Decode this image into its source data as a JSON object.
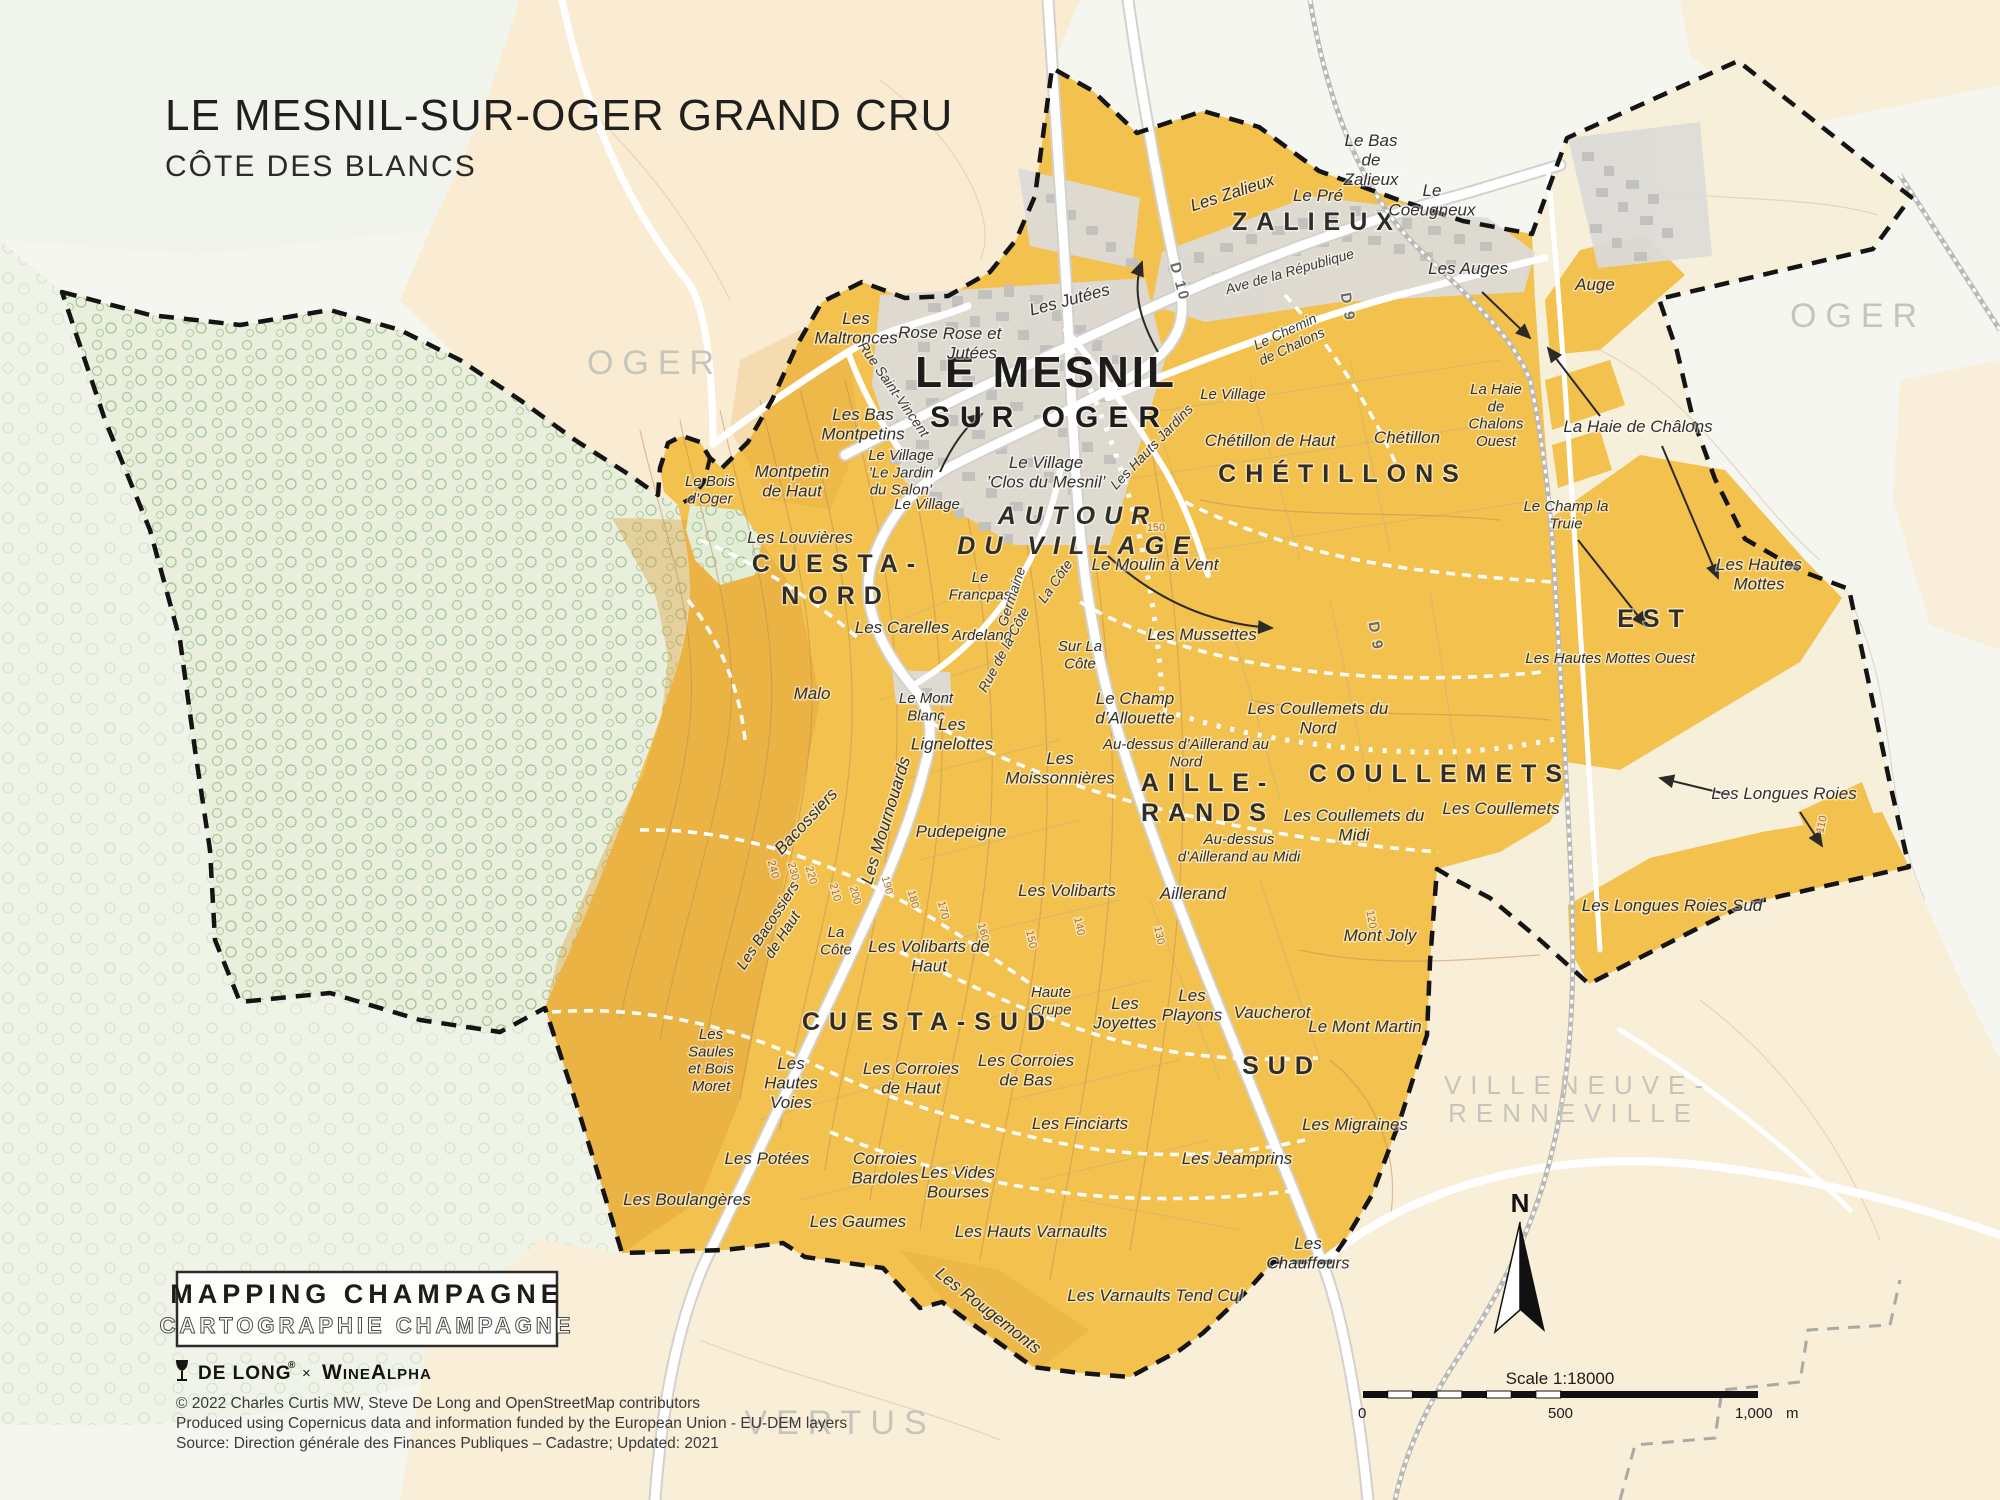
{
  "title": {
    "main": "LE MESNIL-SUR-OGER GRAND CRU",
    "subtitle": "CÔTE DES BLANCS"
  },
  "north": {
    "label": "N"
  },
  "scale_bar": {
    "title": "Scale 1:18000",
    "ticks": [
      "0",
      "500",
      "1,000"
    ],
    "unit": "m"
  },
  "footer": {
    "brand_primary": "MAPPING CHAMPAGNE",
    "brand_secondary": "CARTOGRAPHIE CHAMPAGNE",
    "logo_text": "DE LONG",
    "logo_reg": "®",
    "logo_sep": "×",
    "logo_partner": "WineAlpha",
    "credits": [
      "© 2022 Charles Curtis MW, Steve De Long and OpenStreetMap contributors",
      "Produced using Copernicus data and information funded by the European Union - EU-DEM layers",
      "Source: Direction générale des Finances Publiques – Cadastre; Updated: 2021"
    ]
  },
  "colors": {
    "vineyard": "#F2C14E",
    "vineyard_shade": "#DD9E35",
    "forest": "#E9EFDC",
    "forest_tree": "#A9C79B",
    "peach": "#FAECD2",
    "cream": "#F6EFDA",
    "town_block": "#DCDBD7",
    "building": "#C2C1BD",
    "boundary": "#141414",
    "contour": "#BF8A55",
    "neighbor_gray": "#C7C4BC"
  },
  "labels": [
    {
      "t": "CUESTA-",
      "x": 838,
      "y": 572,
      "c": "region"
    },
    {
      "t": "NORD",
      "x": 836,
      "y": 604,
      "c": "region"
    },
    {
      "t": "CUESTA-SUD",
      "x": 928,
      "y": 1030,
      "c": "region"
    },
    {
      "t": "AUTOUR",
      "x": 1078,
      "y": 524,
      "c": "regionI"
    },
    {
      "t": "DU VILLAGE",
      "x": 1078,
      "y": 554,
      "c": "regionI"
    },
    {
      "t": "ZALIEUX",
      "x": 1317,
      "y": 230,
      "c": "region"
    },
    {
      "t": "CHÉTILLONS",
      "x": 1343,
      "y": 482,
      "c": "region"
    },
    {
      "t": "COULLEMETS",
      "x": 1440,
      "y": 782,
      "c": "region"
    },
    {
      "t": "AILLE-",
      "x": 1208,
      "y": 791,
      "c": "region"
    },
    {
      "t": "RANDS",
      "x": 1208,
      "y": 821,
      "c": "region"
    },
    {
      "t": "SUD",
      "x": 1282,
      "y": 1074,
      "c": "region"
    },
    {
      "t": "EST",
      "x": 1655,
      "y": 627,
      "c": "region"
    },
    {
      "t": "LE MESNIL",
      "x": 1046,
      "y": 387,
      "c": "town1"
    },
    {
      "t": "SUR OGER",
      "x": 1050,
      "y": 427,
      "c": "town2"
    },
    {
      "t": "OGER",
      "x": 655,
      "y": 374,
      "c": "neighbor"
    },
    {
      "t": "OGER",
      "x": 1858,
      "y": 327,
      "c": "neighbor"
    },
    {
      "t": "VERTUS",
      "x": 840,
      "y": 1434,
      "c": "neighbor"
    },
    {
      "t": "VILLENEUVE-",
      "x": 1578,
      "y": 1094,
      "c": "neighbor",
      "s": 26
    },
    {
      "t": "RENNEVILLE",
      "x": 1574,
      "y": 1122,
      "c": "neighbor",
      "s": 26
    },
    {
      "lines": [
        "Les",
        "Maltronces"
      ],
      "x": 856,
      "y": 324,
      "c": "lieu"
    },
    {
      "t": "Rose",
      "x": 918,
      "y": 338,
      "c": "lieu"
    },
    {
      "lines": [
        "Rose et",
        "Jutées"
      ],
      "x": 972,
      "y": 339,
      "c": "lieu"
    },
    {
      "t": "Les Jutées",
      "x": 1071,
      "y": 305,
      "c": "lieu",
      "r": -15
    },
    {
      "t": "Le Pré",
      "x": 1318,
      "y": 201,
      "c": "lieu"
    },
    {
      "lines": [
        "Le Bas",
        "de",
        "Zalieux"
      ],
      "x": 1371,
      "y": 146,
      "c": "lieu"
    },
    {
      "lines": [
        "Le",
        "Coeugneux"
      ],
      "x": 1432,
      "y": 196,
      "c": "lieu"
    },
    {
      "t": "Les Zalieux",
      "x": 1234,
      "y": 198,
      "c": "lieu",
      "r": -18
    },
    {
      "t": "Les Auges",
      "x": 1468,
      "y": 274,
      "c": "lieu"
    },
    {
      "t": "Auge",
      "x": 1595,
      "y": 290,
      "c": "lieu"
    },
    {
      "lines": [
        "La Haie",
        "de",
        "Chalons",
        "Ouest"
      ],
      "x": 1496,
      "y": 394,
      "c": "lieu",
      "s": 15
    },
    {
      "t": "La Haie de Châlons",
      "x": 1638,
      "y": 432,
      "c": "lieu"
    },
    {
      "lines": [
        "Le Champ la",
        "Truie"
      ],
      "x": 1566,
      "y": 511,
      "c": "lieu",
      "s": 15
    },
    {
      "lines": [
        "Les Hautes",
        "Mottes"
      ],
      "x": 1759,
      "y": 570,
      "c": "lieu"
    },
    {
      "t": "Les Hautes Mottes Ouest",
      "x": 1610,
      "y": 663,
      "c": "lieu",
      "s": 15
    },
    {
      "t": "Les Longues Roies",
      "x": 1784,
      "y": 799,
      "c": "lieu"
    },
    {
      "t": "Les Longues Roies Sud",
      "x": 1672,
      "y": 911,
      "c": "lieu"
    },
    {
      "lines": [
        "Les Bas",
        "Montpetins"
      ],
      "x": 863,
      "y": 420,
      "c": "lieu"
    },
    {
      "lines": [
        "Le Village",
        "’Le Jardin",
        "du Salon’"
      ],
      "x": 901,
      "y": 460,
      "c": "lieu",
      "s": 15
    },
    {
      "lines": [
        "Le Village",
        "’Clos du Mesnil’"
      ],
      "x": 1046,
      "y": 468,
      "c": "lieu"
    },
    {
      "t": "Le Village",
      "x": 927,
      "y": 509,
      "c": "lieu",
      "s": 15
    },
    {
      "t": "Le Village",
      "x": 1233,
      "y": 399,
      "c": "lieu",
      "s": 15
    },
    {
      "lines": [
        "Montpetin",
        "de Haut"
      ],
      "x": 792,
      "y": 477,
      "c": "lieu"
    },
    {
      "lines": [
        "Le Bois",
        "d’Oger"
      ],
      "x": 710,
      "y": 486,
      "c": "lieu",
      "s": 15
    },
    {
      "t": "Les Louvières",
      "x": 800,
      "y": 543,
      "c": "lieu"
    },
    {
      "t": "Les Carelles",
      "x": 902,
      "y": 633,
      "c": "lieu"
    },
    {
      "t": "Malo",
      "x": 812,
      "y": 699,
      "c": "lieu"
    },
    {
      "lines": [
        "Le",
        "Francpas"
      ],
      "x": 980,
      "y": 582,
      "c": "lieu",
      "s": 15
    },
    {
      "t": "Ardeland",
      "x": 982,
      "y": 640,
      "c": "lieu",
      "s": 15
    },
    {
      "lines": [
        "Sur La",
        "Côte"
      ],
      "x": 1080,
      "y": 651,
      "c": "lieu",
      "s": 15
    },
    {
      "lines": [
        "Le Mont",
        "Blanc"
      ],
      "x": 926,
      "y": 703,
      "c": "lieu",
      "s": 15
    },
    {
      "lines": [
        "Les",
        "Lignelottes"
      ],
      "x": 952,
      "y": 730,
      "c": "lieu"
    },
    {
      "lines": [
        "Les",
        "Moissonnières"
      ],
      "x": 1060,
      "y": 764,
      "c": "lieu"
    },
    {
      "t": "Chétillon de Haut",
      "x": 1270,
      "y": 446,
      "c": "lieu"
    },
    {
      "t": "Chétillon",
      "x": 1407,
      "y": 443,
      "c": "lieu"
    },
    {
      "t": "Le Moulin à Vent",
      "x": 1155,
      "y": 570,
      "c": "lieu"
    },
    {
      "t": "Les Mussettes",
      "x": 1202,
      "y": 640,
      "c": "lieu"
    },
    {
      "lines": [
        "Le Champ",
        "d’Allouette"
      ],
      "x": 1135,
      "y": 704,
      "c": "lieu"
    },
    {
      "lines": [
        "Les Coullemets du",
        "Nord"
      ],
      "x": 1318,
      "y": 714,
      "c": "lieu"
    },
    {
      "lines": [
        "Au-dessus d’Aillerand au",
        "Nord"
      ],
      "x": 1186,
      "y": 749,
      "c": "lieu",
      "s": 15
    },
    {
      "lines": [
        "Les Coullemets du",
        "Midi"
      ],
      "x": 1354,
      "y": 821,
      "c": "lieu"
    },
    {
      "t": "Les Coullemets",
      "x": 1501,
      "y": 814,
      "c": "lieu"
    },
    {
      "lines": [
        "Au-dessus",
        "d’Aillerand au Midi"
      ],
      "x": 1239,
      "y": 844,
      "c": "lieu",
      "s": 15
    },
    {
      "t": "Aillerand",
      "x": 1193,
      "y": 899,
      "c": "lieu"
    },
    {
      "t": "Les Volibarts",
      "x": 1067,
      "y": 896,
      "c": "lieu"
    },
    {
      "t": "Mont Joly",
      "x": 1380,
      "y": 941,
      "c": "lieu"
    },
    {
      "t": "Bacossiers",
      "x": 810,
      "y": 825,
      "c": "lieu",
      "r": -47
    },
    {
      "t": "Les Mournouards",
      "x": 891,
      "y": 822,
      "c": "lieu",
      "r": -73
    },
    {
      "t": "Pudepeigne",
      "x": 961,
      "y": 837,
      "c": "lieu"
    },
    {
      "lines": [
        "Les Bacossiers",
        "de Haut"
      ],
      "x": 772,
      "y": 928,
      "c": "lieu",
      "r": -57,
      "s": 15
    },
    {
      "lines": [
        "La",
        "Côte"
      ],
      "x": 836,
      "y": 937,
      "c": "lieu",
      "s": 15
    },
    {
      "lines": [
        "Les Volibarts de",
        "Haut"
      ],
      "x": 929,
      "y": 952,
      "c": "lieu"
    },
    {
      "lines": [
        "Haute",
        "Crupe"
      ],
      "x": 1051,
      "y": 997,
      "c": "lieu",
      "s": 15
    },
    {
      "lines": [
        "Les",
        "Joyettes"
      ],
      "x": 1125,
      "y": 1009,
      "c": "lieu"
    },
    {
      "lines": [
        "Les",
        "Playons"
      ],
      "x": 1192,
      "y": 1001,
      "c": "lieu"
    },
    {
      "t": "Vaucherot",
      "x": 1272,
      "y": 1018,
      "c": "lieu"
    },
    {
      "t": "Le Mont Martin",
      "x": 1365,
      "y": 1032,
      "c": "lieu"
    },
    {
      "lines": [
        "Les",
        "Saules",
        "et Bois",
        "Moret"
      ],
      "x": 711,
      "y": 1039,
      "c": "lieu",
      "s": 15
    },
    {
      "lines": [
        "Les",
        "Hautes",
        "Voies"
      ],
      "x": 791,
      "y": 1069,
      "c": "lieu"
    },
    {
      "lines": [
        "Les Corroies",
        "de Haut"
      ],
      "x": 911,
      "y": 1074,
      "c": "lieu"
    },
    {
      "lines": [
        "Les Corroies",
        "de Bas"
      ],
      "x": 1026,
      "y": 1066,
      "c": "lieu"
    },
    {
      "t": "Les Finciarts",
      "x": 1080,
      "y": 1129,
      "c": "lieu"
    },
    {
      "t": "Les Migraines",
      "x": 1355,
      "y": 1130,
      "c": "lieu"
    },
    {
      "t": "Les Jeamprins",
      "x": 1237,
      "y": 1164,
      "c": "lieu"
    },
    {
      "t": "Les Potées",
      "x": 767,
      "y": 1164,
      "c": "lieu"
    },
    {
      "t": "Les Boulangères",
      "x": 687,
      "y": 1205,
      "c": "lieu"
    },
    {
      "lines": [
        "Corroies",
        "Bardoles"
      ],
      "x": 885,
      "y": 1164,
      "c": "lieu"
    },
    {
      "lines": [
        "Les Vides",
        "Bourses"
      ],
      "x": 958,
      "y": 1178,
      "c": "lieu"
    },
    {
      "t": "Les Gaumes",
      "x": 858,
      "y": 1227,
      "c": "lieu"
    },
    {
      "t": "Les Hauts Varnaults",
      "x": 1031,
      "y": 1237,
      "c": "lieu"
    },
    {
      "t": "Les Rougemonts",
      "x": 985,
      "y": 1315,
      "c": "lieu",
      "r": 38
    },
    {
      "t": "Les Varnaults Tend Cul",
      "x": 1155,
      "y": 1301,
      "c": "lieu"
    },
    {
      "lines": [
        "Les",
        "Chauffours"
      ],
      "x": 1308,
      "y": 1249,
      "c": "lieu"
    },
    {
      "t": "Rue Saint-Vincent",
      "x": 890,
      "y": 392,
      "c": "street",
      "r": 55
    },
    {
      "t": "Les Hauts Jardins",
      "x": 1155,
      "y": 450,
      "c": "street",
      "r": -46
    },
    {
      "t": "Ave de la République",
      "x": 1291,
      "y": 276,
      "c": "street",
      "r": -16
    },
    {
      "lines": [
        "Le Chemin",
        "de Chalons"
      ],
      "x": 1287,
      "y": 336,
      "c": "street",
      "r": -25
    },
    {
      "t": "Germaine",
      "x": 1016,
      "y": 598,
      "c": "street",
      "r": -72
    },
    {
      "t": "La Côte",
      "x": 1059,
      "y": 584,
      "c": "street",
      "r": -55
    },
    {
      "t": "Rue de la Côte",
      "x": 1008,
      "y": 652,
      "c": "street",
      "r": -62
    },
    {
      "t": "D 10",
      "x": 1175,
      "y": 283,
      "c": "road",
      "r": 75
    },
    {
      "t": "D 9",
      "x": 1343,
      "y": 308,
      "c": "road",
      "r": 80
    },
    {
      "t": "D 9",
      "x": 1371,
      "y": 637,
      "c": "road",
      "r": 80
    },
    {
      "t": "240",
      "x": 770,
      "y": 870,
      "c": "contour",
      "r": 75
    },
    {
      "t": "230",
      "x": 790,
      "y": 872,
      "c": "contour",
      "r": 75
    },
    {
      "t": "220",
      "x": 808,
      "y": 876,
      "c": "contour",
      "r": 75
    },
    {
      "t": "210",
      "x": 832,
      "y": 893,
      "c": "contour",
      "r": 75
    },
    {
      "t": "200",
      "x": 852,
      "y": 896,
      "c": "contour",
      "r": 75
    },
    {
      "t": "190",
      "x": 884,
      "y": 886,
      "c": "contour",
      "r": 75
    },
    {
      "t": "180",
      "x": 910,
      "y": 900,
      "c": "contour",
      "r": 75
    },
    {
      "t": "170",
      "x": 940,
      "y": 911,
      "c": "contour",
      "r": 75
    },
    {
      "t": "160",
      "x": 980,
      "y": 933,
      "c": "contour",
      "r": 75
    },
    {
      "t": "150",
      "x": 1028,
      "y": 940,
      "c": "contour",
      "r": 78
    },
    {
      "t": "140",
      "x": 1076,
      "y": 927,
      "c": "contour",
      "r": 78
    },
    {
      "t": "130",
      "x": 1156,
      "y": 936,
      "c": "contour",
      "r": 78
    },
    {
      "t": "120",
      "x": 1368,
      "y": 920,
      "c": "contour",
      "r": 80
    },
    {
      "t": "110",
      "x": 1825,
      "y": 825,
      "c": "contour",
      "r": -78
    },
    {
      "t": "150",
      "x": 1156,
      "y": 531,
      "c": "contour"
    }
  ]
}
